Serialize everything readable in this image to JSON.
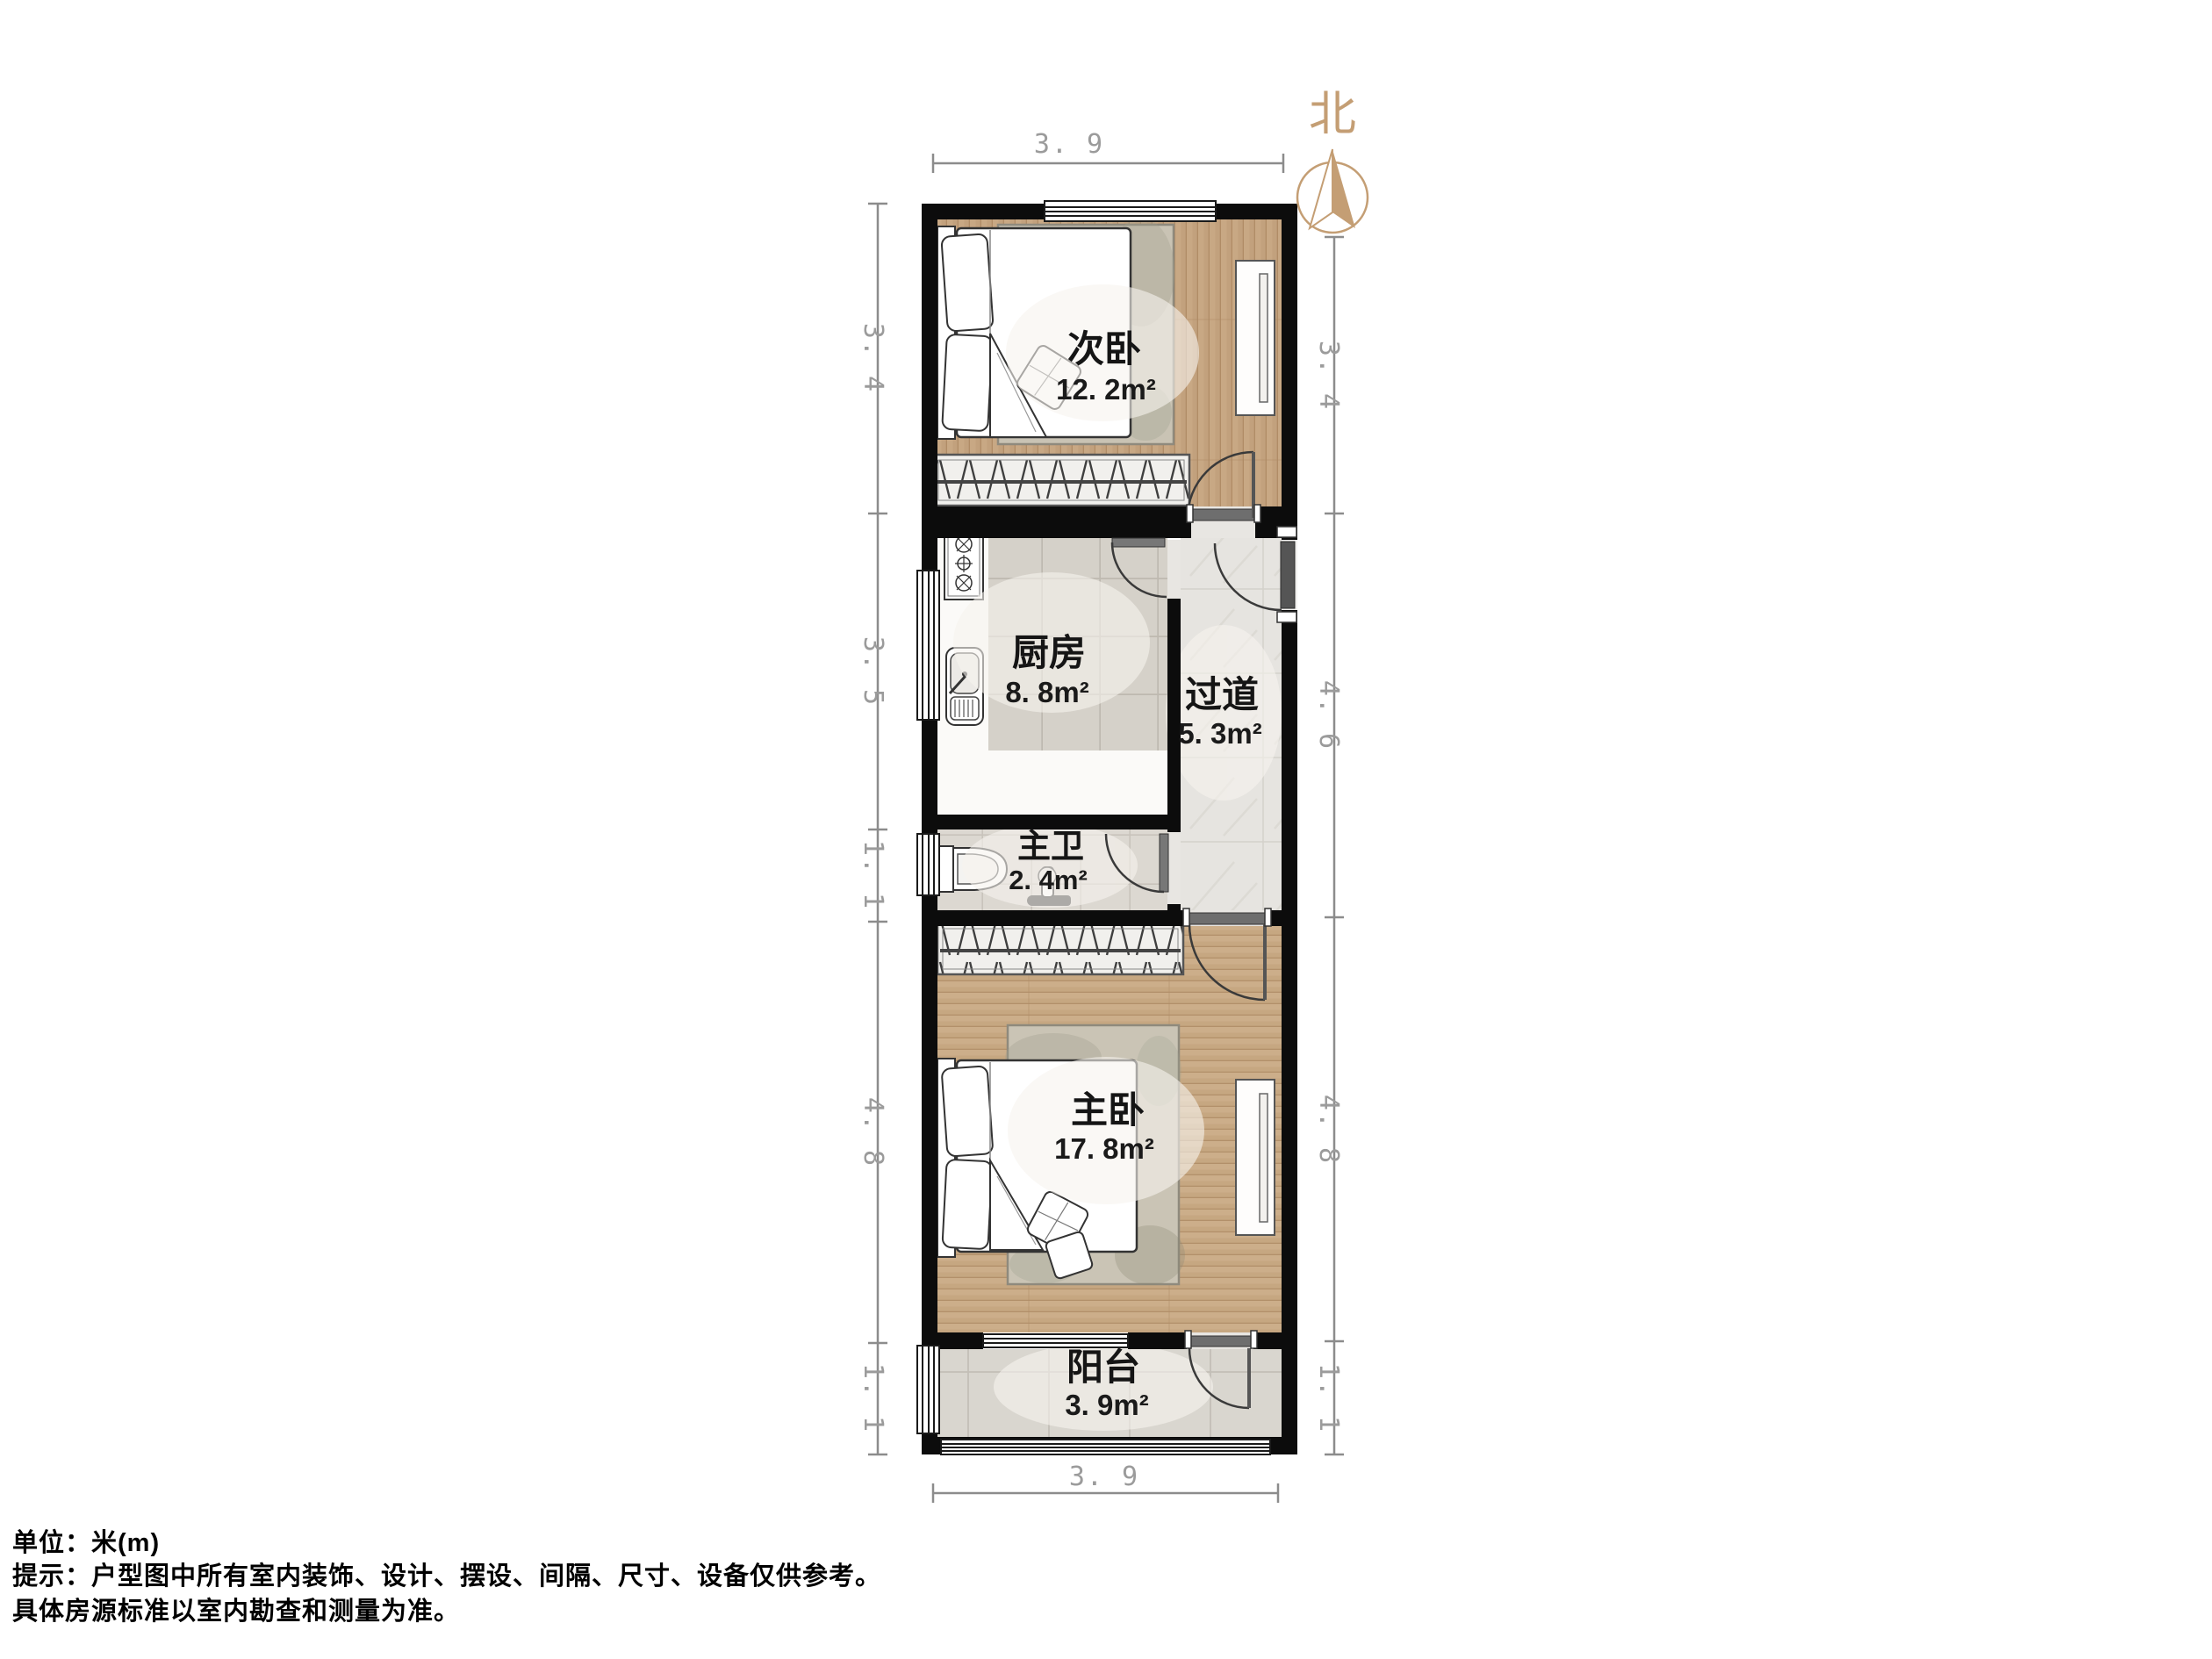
{
  "north": {
    "label": "北"
  },
  "rooms": [
    {
      "name": "次卧",
      "area": "12. 2m²"
    },
    {
      "name": "厨房",
      "area": "8. 8m²"
    },
    {
      "name": "过道",
      "area": "5. 3m²"
    },
    {
      "name": "主卫",
      "area": "2. 4m²"
    },
    {
      "name": "主卧",
      "area": "17. 8m²"
    },
    {
      "name": "阳台",
      "area": "3. 9m²"
    }
  ],
  "dimensions": {
    "top": "3. 9",
    "bottom": "3. 9",
    "left": [
      "3. 4",
      "3. 5",
      "1. 1",
      "4. 8",
      "1. 1"
    ],
    "right": [
      "3. 4",
      "4. 6",
      "4. 8",
      "1. 1"
    ]
  },
  "footer": {
    "unit_line": "单位：米(m)",
    "tip_line": "提示：户型图中所有室内装饰、设计、摆设、间隔、尺寸、设备仅供参考。",
    "note_line": "具体房源标准以室内勘查和测量为准。"
  },
  "colors": {
    "wall": "#0c0c0c",
    "wood": "#c3a47f",
    "tile": "#d7d3cc",
    "marble": "#e5e3df",
    "accent_north": "#c49e74",
    "dim_text": "#9b9b9b",
    "label_text": "#151515"
  }
}
